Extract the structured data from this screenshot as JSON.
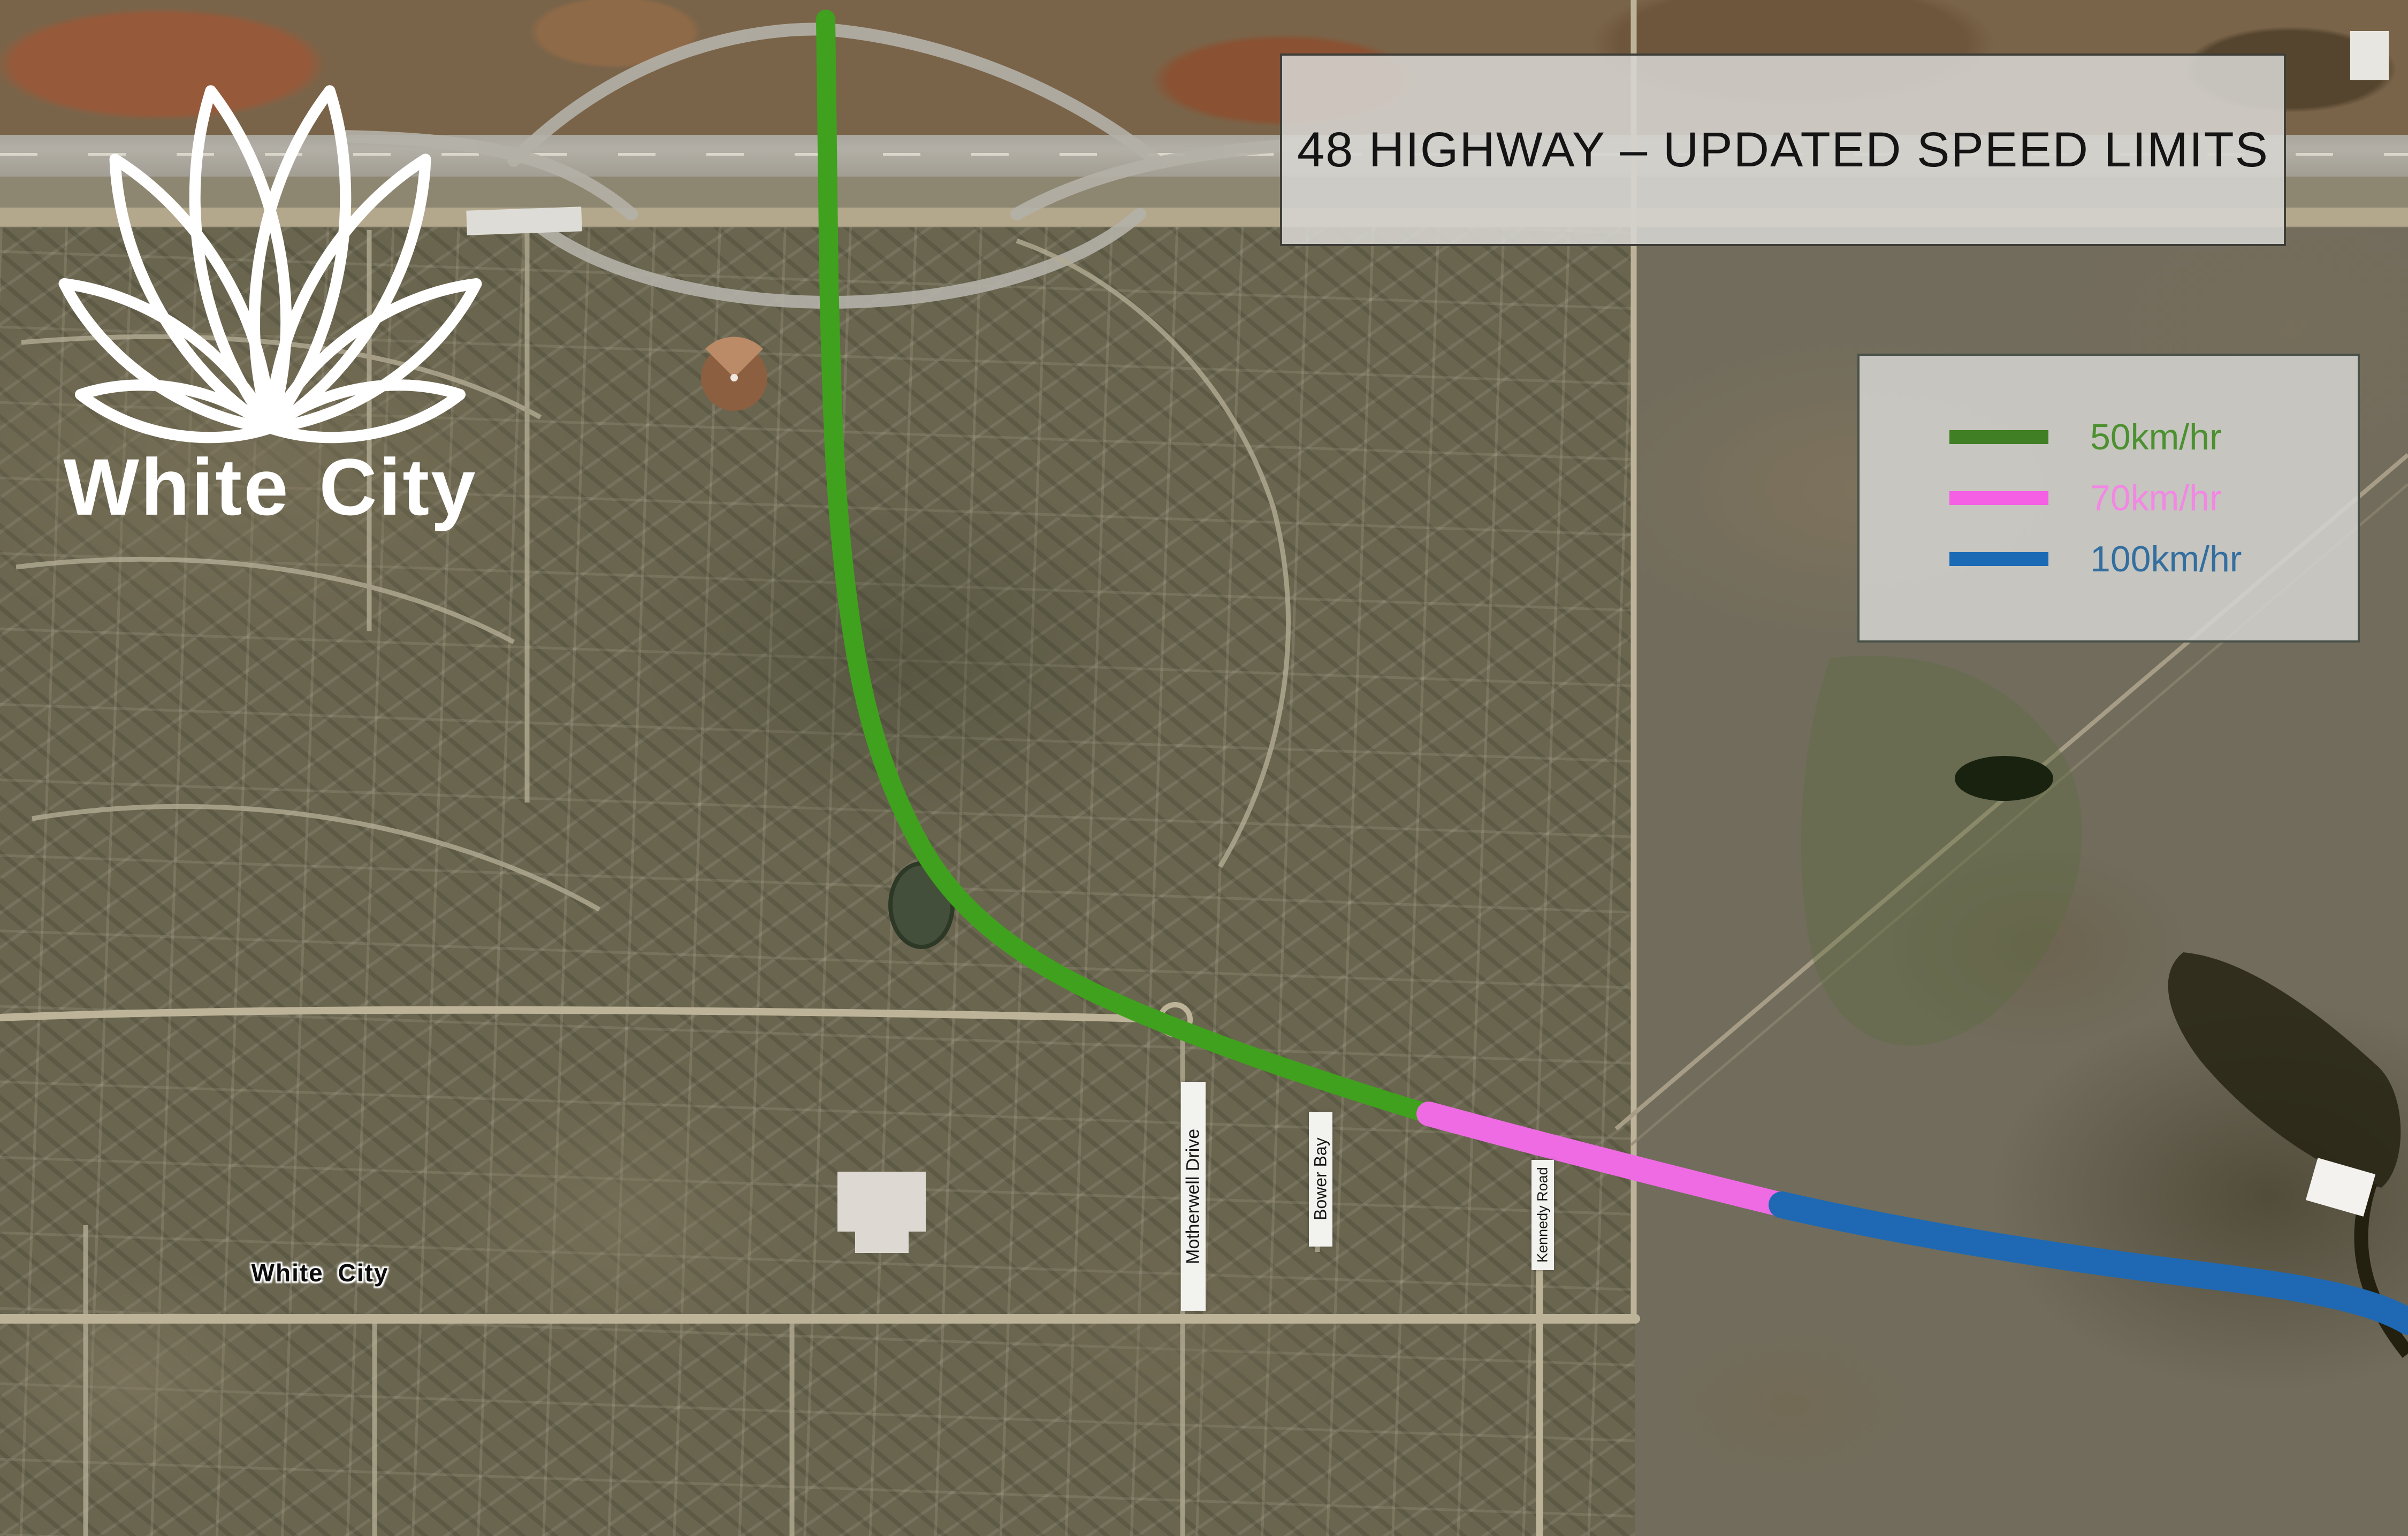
{
  "logo": {
    "wordmark": "White City",
    "icon": "lotus-flower-outline",
    "color": "#ffffff"
  },
  "banner": {
    "title": "48 HIGHWAY – UPDATED SPEED LIMITS"
  },
  "legend": {
    "items": [
      {
        "label": "50km/hr",
        "line_color": "#417f24",
        "label_color": "#4c9030"
      },
      {
        "label": "70km/hr",
        "line_color": "#f45fe3",
        "label_color": "#f287e4"
      },
      {
        "label": "100km/hr",
        "line_color": "#1b6ab6",
        "label_color": "#336e9e"
      }
    ]
  },
  "map": {
    "place_label": "White City",
    "road_labels": [
      {
        "name": "Motherwell Drive"
      },
      {
        "name": "Bower Bay"
      },
      {
        "name": "Kennedy Road"
      }
    ],
    "routes": [
      {
        "name": "50km/hr segment",
        "color": "#3fa11d"
      },
      {
        "name": "70km/hr segment",
        "color": "#ee6be3"
      },
      {
        "name": "100km/hr segment",
        "color": "#1f69b4"
      }
    ]
  }
}
